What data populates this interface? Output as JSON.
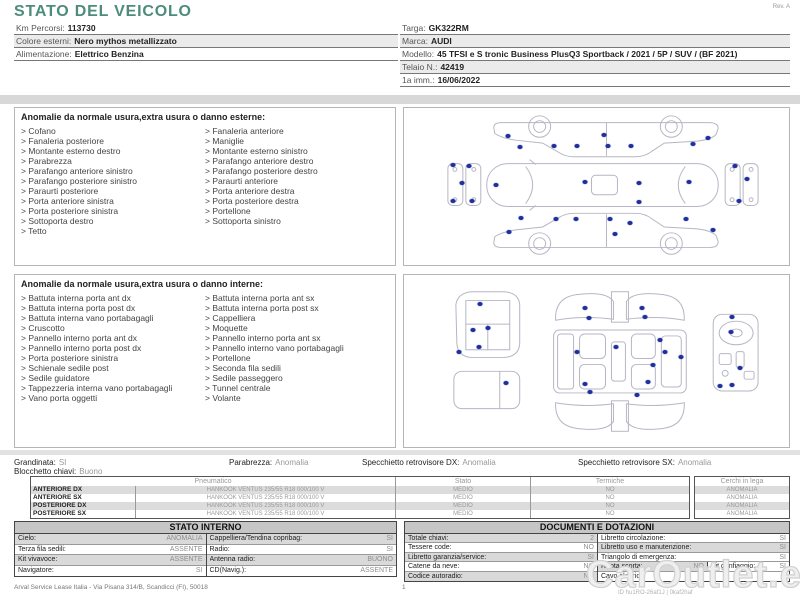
{
  "bullet": ">",
  "colors": {
    "accent": "#4d8b7b",
    "damage_dot": "#202f9e"
  },
  "header": {
    "title": "STATO DEL VEICOLO",
    "rev": "Rev. A",
    "left_fields": [
      {
        "label": "Km Percorsi:",
        "value": "113730"
      },
      {
        "label": "Colore esterni:",
        "value": "Nero mythos metallizzato"
      },
      {
        "label": "Alimentazione:",
        "value": "Elettrico Benzina"
      }
    ],
    "right_fields": [
      {
        "label": "Targa:",
        "value": "GK322RM"
      },
      {
        "label": "Marca:",
        "value": "AUDI"
      },
      {
        "label": "Modello:",
        "value": "45 TFSI e S tronic Business PlusQ3 Sportback / 2021 / 5P / SUV / (BF 2021)"
      },
      {
        "label": "Telaio N.:",
        "value": "42419"
      },
      {
        "label": "1a imm.:",
        "value": "16/06/2022"
      }
    ]
  },
  "exterior_box": {
    "title": "Anomalie da normale usura,extra usura o danno esterne:",
    "left_items": [
      "Cofano",
      "Fanaleria posteriore",
      "Montante esterno destro",
      "Parabrezza",
      "Parafango anteriore sinistro",
      "Parafango posteriore sinistro",
      "Paraurti posteriore",
      "Porta anteriore sinistra",
      "Porta posteriore sinistra",
      "Sottoporta destro",
      "Tetto"
    ],
    "right_items": [
      "Fanaleria anteriore",
      "Maniglie",
      "Montante esterno sinistro",
      "Parafango anteriore destro",
      "Parafango posteriore destro",
      "Paraurti anteriore",
      "Porta anteriore destra",
      "Porta posteriore destra",
      "Portellone",
      "Sottoporta sinistro"
    ],
    "damage_dots": [
      [
        27,
        18
      ],
      [
        30,
        25
      ],
      [
        39,
        24
      ],
      [
        45,
        24
      ],
      [
        52,
        17
      ],
      [
        53,
        24
      ],
      [
        59,
        24
      ],
      [
        75,
        23
      ],
      [
        79,
        19
      ],
      [
        24,
        49
      ],
      [
        47,
        47
      ],
      [
        61,
        48
      ],
      [
        74,
        47
      ],
      [
        61,
        60
      ],
      [
        12.7,
        36
      ],
      [
        17,
        37
      ],
      [
        15,
        48
      ],
      [
        12.7,
        59
      ],
      [
        17.6,
        59
      ],
      [
        86,
        37
      ],
      [
        89,
        45
      ],
      [
        87,
        59
      ],
      [
        30.5,
        70
      ],
      [
        39.6,
        71
      ],
      [
        44.8,
        71
      ],
      [
        53.6,
        71
      ],
      [
        58.8,
        73
      ],
      [
        73.3,
        71
      ],
      [
        27.2,
        79
      ],
      [
        54.9,
        80
      ],
      [
        80.3,
        77.6
      ]
    ]
  },
  "interior_box": {
    "title": "Anomalie da normale usura,extra usura o danno interne:",
    "left_items": [
      "Battuta interna porta ant dx",
      "Battuta interna porta post dx",
      "Battuta interna vano portabagagli",
      "Cruscotto",
      "Pannello interno porta ant dx",
      "Pannello interno porta post dx",
      "Porta posteriore sinistra",
      "Schienale sedile post",
      "Sedile guidatore",
      "Tappezzeria interna vano portabagagli",
      "Vano porta oggetti"
    ],
    "right_items": [
      "Battuta interna porta ant sx",
      "Battuta interna porta post sx",
      "Cappelliera",
      "Moquette",
      "Pannello interno porta ant sx",
      "Pannello interno vano portabagagli",
      "Portellone",
      "Seconda fila sedili",
      "Sedile passeggero",
      "Tunnel centrale",
      "Volante"
    ],
    "damage_dots": [
      [
        19.7,
        17
      ],
      [
        18,
        32
      ],
      [
        21.8,
        31
      ],
      [
        19.4,
        42
      ],
      [
        14.2,
        45
      ],
      [
        26.4,
        63
      ],
      [
        47,
        19.4
      ],
      [
        61.7,
        19
      ],
      [
        48,
        25
      ],
      [
        62.7,
        24.6
      ],
      [
        45,
        44.6
      ],
      [
        55,
        42
      ],
      [
        66.6,
        37.7
      ],
      [
        67.9,
        44.6
      ],
      [
        72,
        47.4
      ],
      [
        64.8,
        52.6
      ],
      [
        47,
        63.4
      ],
      [
        63.5,
        62.3
      ],
      [
        48.4,
        68
      ],
      [
        60.6,
        70
      ],
      [
        85.2,
        24.6
      ],
      [
        85,
        33
      ],
      [
        87.3,
        54.3
      ],
      [
        82.1,
        64.6
      ],
      [
        85.2,
        64
      ]
    ]
  },
  "summary": {
    "grandinata": {
      "label": "Grandinata:",
      "value": "SI"
    },
    "blocchetto": {
      "label": "Blocchetto chiavi:",
      "value": "Buono"
    },
    "parabrezza": {
      "label": "Parabrezza:",
      "value": "Anomalia"
    },
    "specchietto_dx": {
      "label": "Specchietto retrovisore DX:",
      "value": "Anomalia"
    },
    "specchietto_sx": {
      "label": "Specchietto retrovisore SX:",
      "value": "Anomalia"
    }
  },
  "tires": {
    "headers": [
      "Pneumatico",
      "Stato",
      "Termiche"
    ],
    "cerchi_header": "Cerchi in lega",
    "rows": [
      {
        "position": "ANTERIORE DX",
        "tire": "HANKOOK VENTUS 235/55 R18 000/100 V",
        "stato": "MEDIO",
        "termiche": "NO",
        "cerchi": "ANOMALIA"
      },
      {
        "position": "ANTERIORE SX",
        "tire": "HANKOOK VENTUS 235/55 R18 000/100 V",
        "stato": "MEDIO",
        "termiche": "NO",
        "cerchi": "ANOMALIA"
      },
      {
        "position": "POSTERIORE DX",
        "tire": "HANKOOK VENTUS 235/55 R18 000/100 V",
        "stato": "MEDIO",
        "termiche": "NO",
        "cerchi": "ANOMALIA"
      },
      {
        "position": "POSTERIORE SX",
        "tire": "HANKOOK VENTUS 235/55 R18 000/100 V",
        "stato": "MEDIO",
        "termiche": "NO",
        "cerchi": "ANOMALIA"
      }
    ]
  },
  "stato_interno": {
    "title": "STATO INTERNO",
    "left_rows": [
      {
        "label": "Cielo:",
        "value": "ANOMALIA"
      },
      {
        "label": "Terza fila sedili:",
        "value": "ASSENTE"
      },
      {
        "label": "Kit vivavoce:",
        "value": "ASSENTE"
      },
      {
        "label": "Navigatore:",
        "value": "SI"
      }
    ],
    "right_rows": [
      {
        "label": "Cappelliera/Tendina copribag:",
        "value": "SI"
      },
      {
        "label": "Radio:",
        "value": "SI"
      },
      {
        "label": "Antenna radio:",
        "value": "BUONO"
      },
      {
        "label": "CD(Navig.):",
        "value": "ASSENTE"
      }
    ]
  },
  "documenti": {
    "title": "DOCUMENTI E DOTAZIONI",
    "left_rows": [
      {
        "label": "Totale chiavi:",
        "value": "2"
      },
      {
        "label": "Tessere code:",
        "value": "NO"
      },
      {
        "label": "Libretto garanzia/service:",
        "value": "SI"
      },
      {
        "label": "Catene da neve:",
        "value": "NO"
      },
      {
        "label": "Codice autoradio:",
        "value": "NO"
      }
    ],
    "right_rows": [
      {
        "label": "Libretto circolazione:",
        "value": "SI"
      },
      {
        "label": "Libretto uso e manutenzione:",
        "value": "SI"
      },
      {
        "label": "Triangolo di emergenza:",
        "value": "SI"
      },
      {
        "label": "Ruota scorta:",
        "value": "NO",
        "label2": "Kit gonfiaggio:",
        "value2": "SI"
      },
      {
        "label": "Cavo elettrico:",
        "value": ""
      }
    ]
  },
  "footer": {
    "company": "Arval Service Lease Italia - Via Pisana 314/B, Scandicci (FI), 50018",
    "page": "1",
    "watermark": "CarOutlet.eu",
    "doc_id": "ID hu1RO-26af1J | 0kaf2haf"
  }
}
